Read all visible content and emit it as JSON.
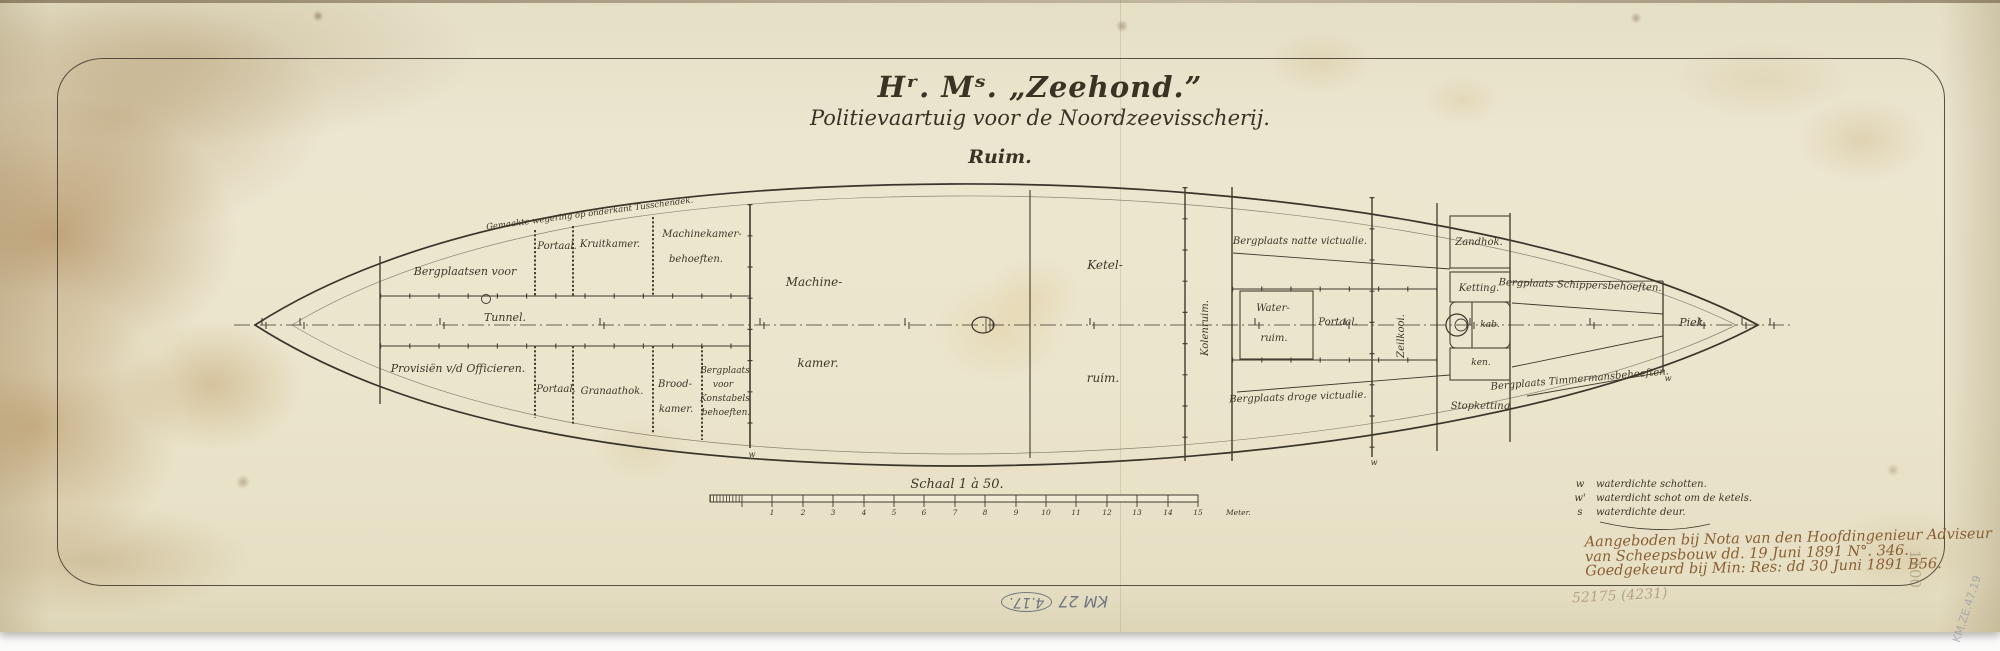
{
  "title": {
    "main": "Hʳ. Mˢ. „Zeehond.”",
    "subtitle": "Politievaartuig voor de Noordzeevisscherij.",
    "section": "Ruim."
  },
  "plan": {
    "labels": {
      "wegering_note": "Gemaakte wegering op onderkant Tusschendek.",
      "bergplaatsen_voor": "Bergplaatsen voor",
      "portaal_top": "Portaal.",
      "kruitkamer": "Kruitkamer.",
      "machinekamer_behoeften_1": "Machinekamer-",
      "machinekamer_behoeften_2": "behoeften.",
      "tunnel": "Tunnel.",
      "machine_1": "Machine-",
      "machine_2": "kamer.",
      "ketel_1": "Ketel-",
      "ketel_2": "ruim.",
      "kolenruim": "Kolenruim.",
      "natte_victualie": "Bergplaats natte victualie.",
      "water_1": "Water-",
      "water_2": "ruim.",
      "portaal_mid": "Portaal.",
      "zeilkooi": "Zeilkooi.",
      "zandhok": "Zandhok.",
      "ketting": "Ketting.",
      "kab": "kab.",
      "ken": "ken.",
      "stopketting": "Stopketting.",
      "schippers": "Bergplaats Schippersbehoeften.",
      "timmermans": "Bergplaats Timmermansbehoeften.",
      "piek": "Piek.",
      "provisien": "Provisiën v/d Officieren.",
      "portaal_bottom": "Portaal.",
      "granaathok": "Granaathok.",
      "brood_1": "Brood-",
      "brood_2": "kamer.",
      "konstabel_1": "Bergplaats",
      "konstabel_2": "voor",
      "konstabel_3": "Konstabels",
      "konstabel_4": "behoeften.",
      "droge_victualie": "Bergplaats droge victualie.",
      "w_mark_1": "w",
      "w_mark_2": "w",
      "w_mark_3": "w"
    }
  },
  "scale_bar": {
    "caption": "Schaal 1 à 50.",
    "ticks": [
      "1",
      "2",
      "3",
      "4",
      "5",
      "6",
      "7",
      "8",
      "9",
      "10",
      "11",
      "12",
      "13",
      "14",
      "15"
    ],
    "unit": "Meter."
  },
  "legend": {
    "rows": [
      {
        "symbol": "w",
        "text": "waterdichte schotten."
      },
      {
        "symbol": "w'",
        "text": "waterdicht schot om de ketels."
      },
      {
        "symbol": "s",
        "text": "waterdichte deur."
      }
    ]
  },
  "notes": {
    "line1": "Aangeboden bij Nota van den Hoofdingenieur Adviseur",
    "line2": "van Scheepsbouw dd. 19 Juni 1891 N°. 346.",
    "line3": "Goedgekeurd bij Min: Res: dd 30 Juni 1891 B56."
  },
  "annotations": {
    "pencil_code": "KM 27",
    "pencil_circled": "4.17.",
    "faint_number": "52175 (4231)",
    "edge_number": "1100",
    "corner_code": "KM.ZE.47.19"
  },
  "colors": {
    "ink": "#3d3627",
    "sepia": "#8a5f33",
    "pencil": "#6e7585",
    "paper": "#ebe5cd"
  }
}
